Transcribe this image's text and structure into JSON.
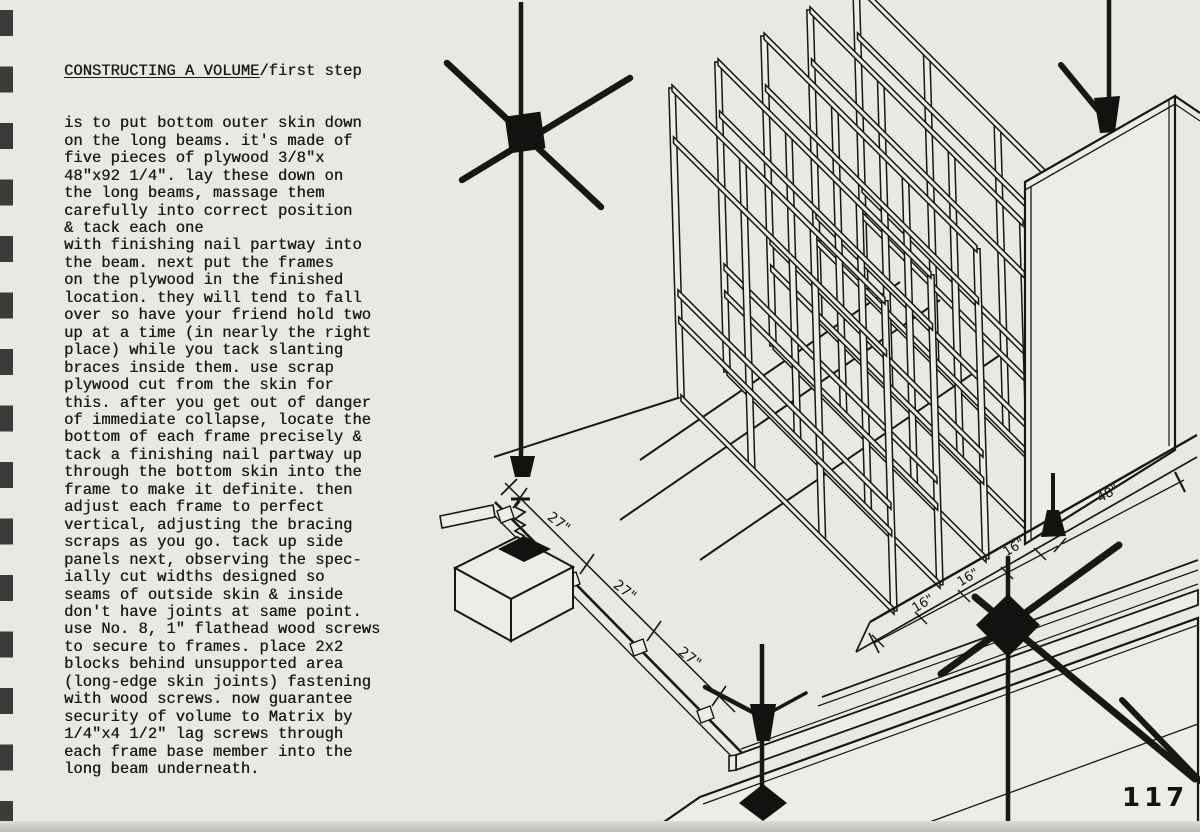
{
  "page": {
    "number": "117",
    "binding_marks": 15
  },
  "article": {
    "title": "CONSTRUCTING A VOLUME",
    "title_suffix": "/first step",
    "body_lines": [
      "is to put bottom outer skin down",
      "on the long beams. it's made of",
      "five pieces of plywood 3/8\"x",
      "48\"x92 1/4\". lay these down on",
      "the long beams, massage them",
      "carefully into correct position",
      "& tack each one",
      "with finishing nail partway into",
      "the beam. next put the frames",
      "on the plywood in the finished",
      "location. they will tend to fall",
      "over so have your friend hold two",
      "up at a time (in nearly the right",
      "place) while you tack slanting",
      "braces inside them. use scrap",
      "plywood cut from the skin for",
      "this. after you get out of danger",
      "of immediate collapse, locate the",
      "bottom of each frame precisely &",
      "tack a finishing nail partway up",
      "through the bottom skin into the",
      "frame to make it definite. then",
      "adjust each frame to perfect",
      "vertical, adjusting the bracing",
      "scraps as you go. tack up side",
      "panels next, observing the spec-",
      "ially cut widths designed so",
      "seams of outside skin & inside",
      "don't have joints at same point.",
      "use No. 8, 1\" flathead wood screws",
      "to secure to frames. place 2x2",
      "blocks behind unsupported area",
      "(long-edge skin joints) fastening",
      "with wood screws. now guarantee",
      "security of volume to Matrix by",
      "1/4\"x4 1/2\" lag screws through",
      "each frame base member into the",
      "long beam underneath."
    ]
  },
  "diagram": {
    "labels": {
      "dim27": [
        "27\"",
        "27\"",
        "27\""
      ],
      "dim16": [
        "16\"",
        "16\"",
        "16\""
      ],
      "dim48": "48\""
    }
  },
  "colors": {
    "paper": "#e9e8e3",
    "ink": "#171714",
    "binding": "#3b3b39"
  }
}
